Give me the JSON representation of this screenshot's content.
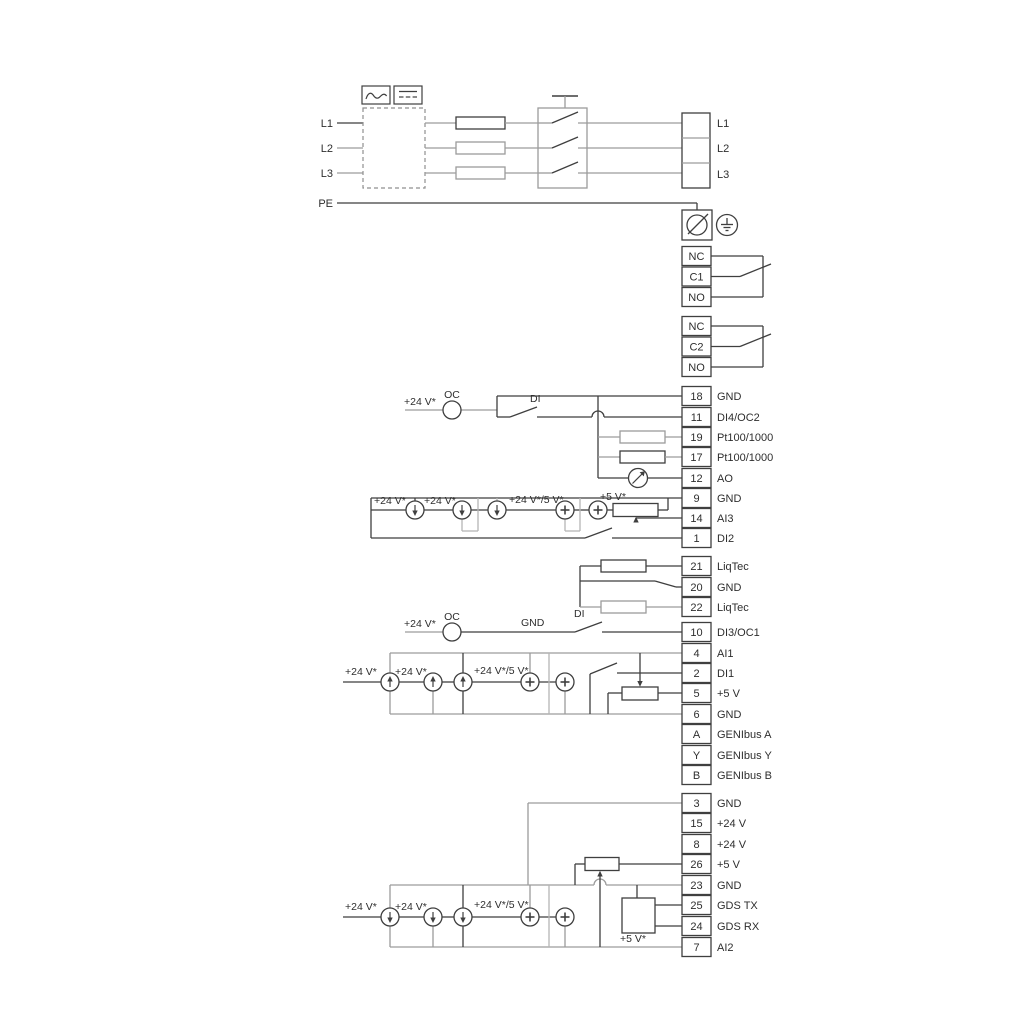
{
  "diagram": {
    "power": {
      "left": [
        "L1",
        "L2",
        "L3"
      ],
      "pe": "PE",
      "right": [
        "L1",
        "L2",
        "L3"
      ]
    },
    "relays": [
      [
        "NC",
        "C1",
        "NO"
      ],
      [
        "NC",
        "C2",
        "NO"
      ]
    ],
    "terminals": [
      {
        "id": "18",
        "label": "GND"
      },
      {
        "id": "11",
        "label": "DI4/OC2"
      },
      {
        "id": "19",
        "label": "Pt100/1000"
      },
      {
        "id": "17",
        "label": "Pt100/1000"
      },
      {
        "id": "12",
        "label": "AO"
      },
      {
        "id": "9",
        "label": "GND"
      },
      {
        "id": "14",
        "label": "AI3"
      },
      {
        "id": "1",
        "label": "DI2"
      },
      {
        "id": "21",
        "label": "LiqTec"
      },
      {
        "id": "20",
        "label": "GND"
      },
      {
        "id": "22",
        "label": "LiqTec"
      },
      {
        "id": "10",
        "label": "DI3/OC1"
      },
      {
        "id": "4",
        "label": "AI1"
      },
      {
        "id": "2",
        "label": "DI1"
      },
      {
        "id": "5",
        "label": "+5 V"
      },
      {
        "id": "6",
        "label": "GND"
      },
      {
        "id": "A",
        "label": "GENIbus A"
      },
      {
        "id": "Y",
        "label": "GENIbus Y"
      },
      {
        "id": "B",
        "label": "GENIbus B"
      },
      {
        "id": "3",
        "label": "GND"
      },
      {
        "id": "15",
        "label": "+24 V"
      },
      {
        "id": "8",
        "label": "+24 V"
      },
      {
        "id": "26",
        "label": "+5 V"
      },
      {
        "id": "23",
        "label": "GND"
      },
      {
        "id": "25",
        "label": "GDS TX"
      },
      {
        "id": "24",
        "label": "GDS RX"
      },
      {
        "id": "7",
        "label": "AI2"
      }
    ],
    "ann": {
      "v24": "+24 V*",
      "v24v5": "+24 V*/5 V*",
      "v5": "+5 V*",
      "oc": "OC",
      "di": "DI",
      "gnd": "GND"
    },
    "colors": {
      "dark": "#3f3f3f",
      "gray": "#9c9c9c",
      "bracket": "#b5b5b5",
      "text": "#2e2e2e"
    }
  }
}
